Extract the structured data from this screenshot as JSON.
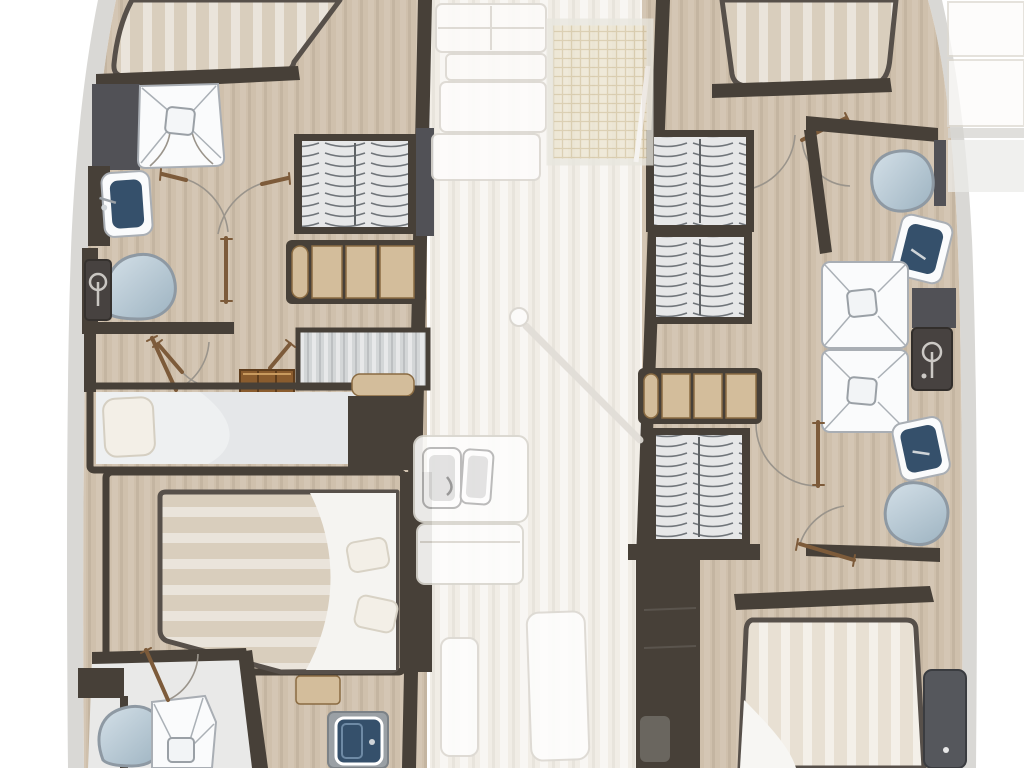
{
  "meta": {
    "title": "Catamaran interior floor plan",
    "description": "Top-down yacht layout diagram: port and starboard hulls with berths, heads, showers, washbasins, toilets and hanging lockers; faded bridgedeck saloon with bow seating, trampoline, mast, galley and bench seats between the hulls. No text labels are rendered on the plan."
  },
  "colors": {
    "background": "#ffffff",
    "center_floor": "#f1ede6",
    "hull_floor": "#cfc0ac",
    "wall_dark": "#474038",
    "wall_gray": "#515156",
    "side_deck": "#d9d8d5",
    "mattress": "#d9cebd",
    "mattress_light": "#e8e0d3",
    "mattress_edge": "#57504a",
    "pillow": "#f3efe7",
    "fixture_white": "#fafbfc",
    "fixture_line": "#a9aeb4",
    "basin_navy": "#35506b",
    "toilet_rim": "#8e99a3",
    "locker_bg": "#e6e7e8",
    "locker_line": "#70757a",
    "shelf_wood": "#d3bd9b",
    "step_wood": "#8a5c2e",
    "door_wood": "#7d5b3a",
    "arc_line": "#9a948b",
    "trampoline": "#ece4d1",
    "trampoline_line": "#d3c3a0",
    "faded_line": "#dcd9d2"
  },
  "vessel": {
    "view": "lower deck plan, bow at top",
    "port_hull": [
      "forward-berth",
      "forward-head: shower tray, washbasin, toilet, mixer-panel",
      "hanging-locker",
      "shelf-unit",
      "companionway-sole and steps",
      "single-berth with pillow",
      "double-berth with two pillows",
      "aft-head: toilet, shower tray",
      "vanity-washbasin",
      "nightstand"
    ],
    "starboard_hull": [
      "forward-berth",
      "hanging-locker x3",
      "head: toilet x2, washbasin x2, shower tray x2, mixer-panel",
      "shelf-unit",
      "companionway-steps",
      "aft-double-berth",
      "side-cabinet"
    ],
    "bridgedeck": [
      "bow-seating stack",
      "trampoline",
      "mast with boom shadow",
      "galley with twin sinks",
      "galley-cabinet",
      "saloon-bench x2",
      "aft-deck-boxes"
    ]
  }
}
